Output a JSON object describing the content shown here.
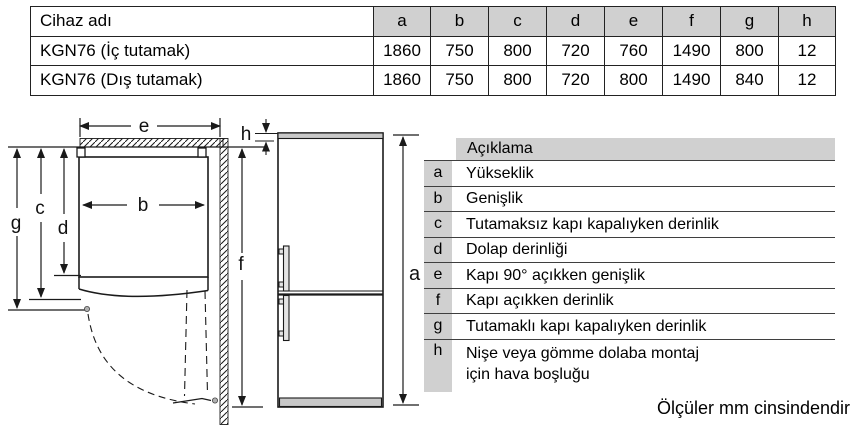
{
  "spec_table": {
    "device_col_header": "Cihaz adı",
    "dim_cols": [
      "a",
      "b",
      "c",
      "d",
      "e",
      "f",
      "g",
      "h"
    ],
    "rows": [
      {
        "name": "KGN76 (İç tutamak)",
        "values": [
          "1860",
          "750",
          "800",
          "720",
          "760",
          "1490",
          "800",
          "12"
        ]
      },
      {
        "name": "KGN76 (Dış tutamak)",
        "values": [
          "1860",
          "750",
          "800",
          "720",
          "800",
          "1490",
          "840",
          "12"
        ]
      }
    ]
  },
  "legend": {
    "header": "Açıklama",
    "rows": [
      {
        "key": "a",
        "desc": "Yükseklik"
      },
      {
        "key": "b",
        "desc": "Genişlik"
      },
      {
        "key": "c",
        "desc": "Tutamaksız kapı kapalıyken derinlik"
      },
      {
        "key": "d",
        "desc": "Dolap derinliği"
      },
      {
        "key": "e",
        "desc": "Kapı 90° açıkken genişlik"
      },
      {
        "key": "f",
        "desc": "Kapı açıkken derinlik"
      },
      {
        "key": "g",
        "desc": "Tutamaklı kapı kapalıyken derinlik"
      },
      {
        "key": "h",
        "desc": "Nişe veya gömme dolaba montaj için hava boşluğu"
      }
    ]
  },
  "diagram": {
    "labels": {
      "a": "a",
      "b": "b",
      "c": "c",
      "d": "d",
      "e": "e",
      "f": "f",
      "g": "g",
      "h": "h"
    }
  },
  "footer_note": "Ölçüler mm cinsindendir",
  "colors": {
    "table_header_fill": "#d0d0d0",
    "line": "#1a1a1a",
    "fridge_strip_fill": "#c8c8c8"
  }
}
